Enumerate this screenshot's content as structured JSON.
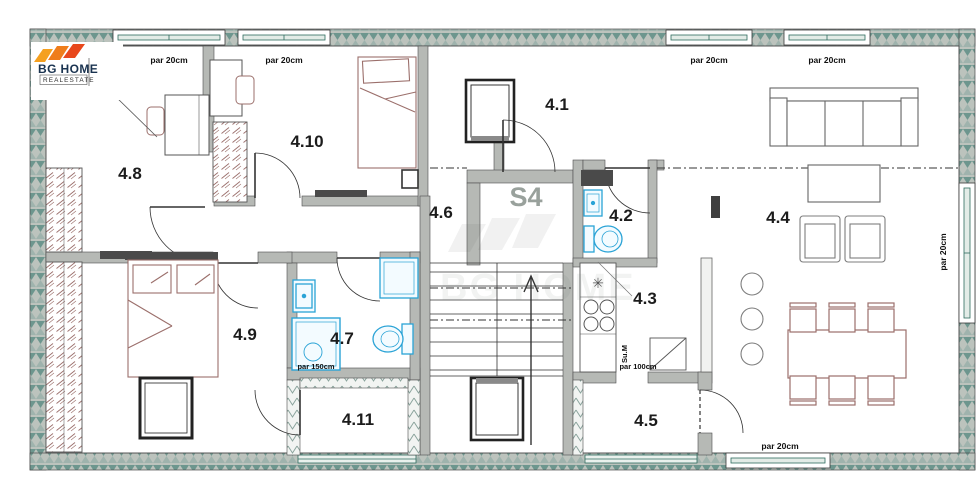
{
  "logo": {
    "name": "BG HOME",
    "sub": "REALESTATE"
  },
  "watermark": {
    "text": "BG HOME"
  },
  "staircase": {
    "label": "S4"
  },
  "rooms": {
    "r41": {
      "label": "4.1"
    },
    "r42": {
      "label": "4.2"
    },
    "r43": {
      "label": "4.3"
    },
    "r44": {
      "label": "4.4"
    },
    "r45": {
      "label": "4.5"
    },
    "r46": {
      "label": "4.6"
    },
    "r47": {
      "label": "4.7"
    },
    "r48": {
      "label": "4.8"
    },
    "r49": {
      "label": "4.9"
    },
    "r410": {
      "label": "4.10"
    },
    "r411": {
      "label": "4.11"
    }
  },
  "annotations": {
    "win_top_1": "par 20cm",
    "win_top_2": "par 20cm",
    "win_top_3": "par 20cm",
    "win_top_4": "par 20cm",
    "win_right": "par 20cm",
    "win_bottom": "par 20cm",
    "shower": "par 150cm",
    "kitchen_pass": "par 100cm",
    "utility": "Su.M"
  },
  "colors": {
    "wall_gray": "#b6b9b5",
    "hatch_teal": "#6d968e",
    "hatch_bg": "#bcc3bd",
    "window_green": "#2e6b5e",
    "fixture_blue": "#2aa3d6",
    "furniture_wood": "#9b6f6b",
    "label_black": "#1c1c1c",
    "stair_gray": "#99a19c",
    "logo_orange_1": "#f5a01f",
    "logo_orange_2": "#ef7d1b",
    "logo_orange_3": "#e8481c"
  }
}
